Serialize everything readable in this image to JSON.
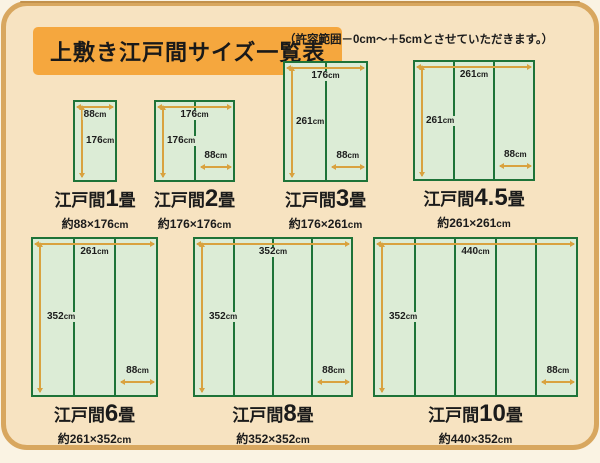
{
  "header": {
    "title": "上敷き江戸間サイズ一覧表",
    "note": "（許容範囲－0cm～＋5cmとさせていただきます。）"
  },
  "labels": {
    "series_prefix": "江戸間",
    "series_suffix": "畳"
  },
  "units": {
    "cm": "cm"
  },
  "mats": [
    {
      "number": "1",
      "size": "約88×176",
      "top_cm": "88",
      "side_cm": "176",
      "bottom_cm": "",
      "strips": 1
    },
    {
      "number": "2",
      "size": "約176×176",
      "top_cm": "176",
      "side_cm": "176",
      "bottom_cm": "88",
      "strips": 2
    },
    {
      "number": "3",
      "size": "約176×261",
      "top_cm": "176",
      "side_cm": "261",
      "bottom_cm": "88",
      "strips": 2
    },
    {
      "number": "4.5",
      "size": "約261×261",
      "top_cm": "261",
      "side_cm": "261",
      "bottom_cm": "88",
      "strips": 3
    },
    {
      "number": "6",
      "size": "約261×352",
      "top_cm": "261",
      "side_cm": "352",
      "bottom_cm": "88",
      "strips": 3
    },
    {
      "number": "8",
      "size": "約352×352",
      "top_cm": "352",
      "side_cm": "352",
      "bottom_cm": "88",
      "strips": 4
    },
    {
      "number": "10",
      "size": "約440×352",
      "top_cm": "440",
      "side_cm": "352",
      "bottom_cm": "88",
      "strips": 5
    }
  ],
  "colors": {
    "accent_orange": "#f5a73e",
    "arrow_orange": "#d9a23f",
    "tatami_border_green": "#1e7338",
    "tatami_fill_green": "#dcecd6",
    "card_cream": "#f7e3c1",
    "frame_tan": "#d8a75f"
  }
}
